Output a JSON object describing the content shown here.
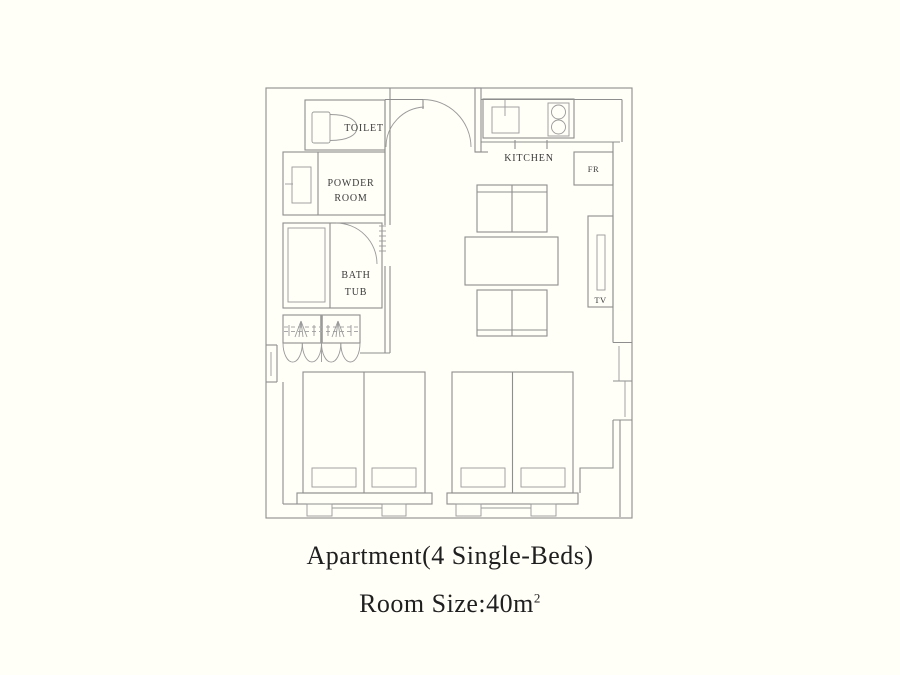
{
  "plan": {
    "labels": {
      "toilet": "TOILET",
      "powder_line1": "POWDER",
      "powder_line2": "ROOM",
      "bath_line1": "BATH",
      "bath_line2": "TUB",
      "kitchen": "KITCHEN",
      "fridge": "FR",
      "tv": "TV"
    },
    "colors": {
      "line": "#8e8e8e",
      "label_text": "#3b3b3b",
      "background": "#FFFEF7",
      "caption_text": "#1f1f1f"
    }
  },
  "captions": {
    "title": "Apartment(4 Single-Beds)",
    "room_size_prefix": "Room Size:40",
    "room_size_unit": "m",
    "room_size_sup": "2"
  }
}
